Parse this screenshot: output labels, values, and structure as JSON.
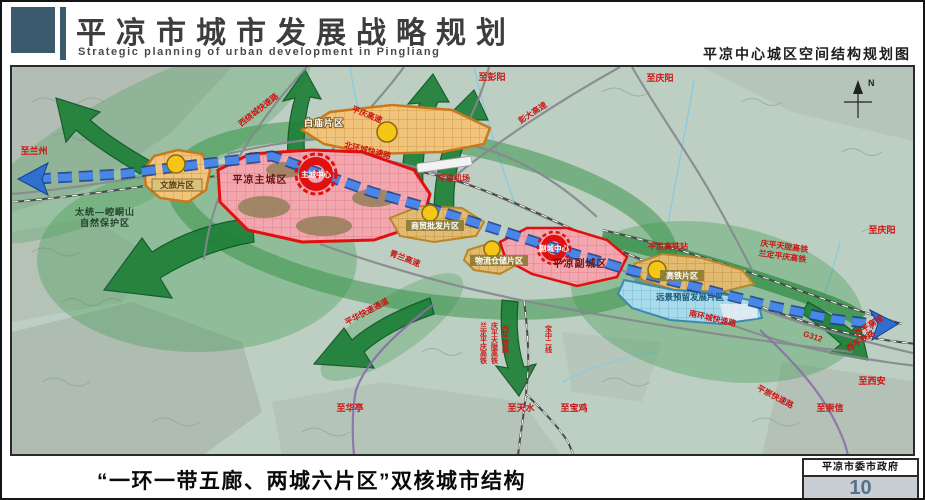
{
  "header": {
    "title": "平凉市城市发展战略规划",
    "subtitle": "Strategic planning of urban development in Pingliang",
    "map_title": "平凉中心城区空间结构规划图"
  },
  "map": {
    "compass": "N",
    "zones": {
      "wenlv": "文旅片区",
      "baimiao": "白庙片区",
      "main_city": "平凉主城区",
      "main_center": "主城中心",
      "shangmao": "商贸批发片区",
      "wuliu": "物流仓储片区",
      "sub_city": "平凉副城区",
      "sub_center": "副城中心",
      "gaotie": "高铁片区",
      "yuanjing": "远景预留发展片区"
    },
    "nature": {
      "line1": "太统—崆峒山",
      "line2": "自然保护区"
    },
    "roads": {
      "west_ring": "西绕城快速路",
      "north_ring": "北环城快速路",
      "south_ring": "南环城快速路",
      "pingqing_expwy": "平庆高速",
      "pengda_expwy": "彭大高速",
      "qinglan_expwy": "青兰高速",
      "xiping_expwy": "西平高速",
      "g312": "G312",
      "pinghua_corridor": "平华快速通道",
      "pingchong_expwy": "平崇快速路",
      "airport": "平凉机场"
    },
    "railways": {
      "hsr_station": "平凉高铁站",
      "qptl_hsr": "庆平天陇高铁",
      "ldpq_hsr": "兰定平庆高铁",
      "qptl_hsr_v": "庆平天陇高铁",
      "ldpq_hsr_v": "兰定平庆高铁",
      "xiping_rail": "西平铁路",
      "xiping_rail_v": "西平铁路",
      "baozhong_rail_v": "宝中二线"
    },
    "directions": {
      "to_lanzhou": "至兰州",
      "to_pengyang": "至彭阳",
      "to_qingyang_n": "至庆阳",
      "to_qingyang_e": "至庆阳",
      "to_xian": "至西安",
      "to_chongxin": "至崇信",
      "to_huating": "至华亭",
      "to_tianshui": "至天水",
      "to_baoji": "至宝鸡"
    }
  },
  "footer": {
    "caption": "“一环一带五廊、两城六片区”双核城市结构",
    "org": "平凉市委市政府",
    "page_number": "10"
  },
  "colors": {
    "header_accent": "#3c5a6e",
    "corridor_green": "#2f8f42",
    "axis_blue": "#2e6fd0",
    "core_red": "#e01010",
    "zone_orange": "#e8b25a",
    "reserve_blue": "#a6d8e8",
    "page_number": "#54718e"
  }
}
